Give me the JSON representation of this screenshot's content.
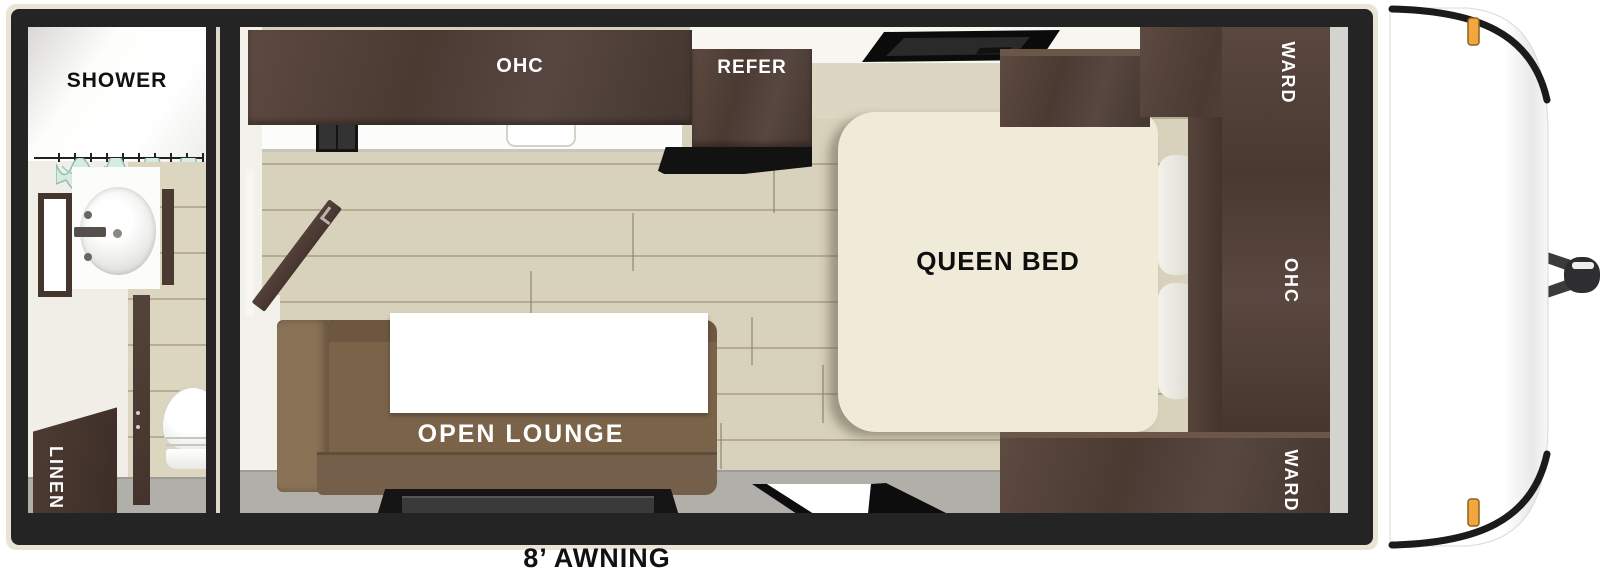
{
  "floorplan": {
    "awning_label": "8’ AWNING",
    "bathroom": {
      "shower_label": "SHOWER",
      "linen_label": "LINEN"
    },
    "kitchen": {
      "overhead_cabinet_label": "OHC",
      "refrigerator_label": "REFER"
    },
    "living": {
      "lounge_label": "OPEN LOUNGE"
    },
    "bedroom": {
      "bed_label": "QUEEN BED",
      "wardrobe_top_label": "WARD",
      "overhead_cabinet_label": "OHC",
      "wardrobe_bottom_label": "WARD"
    },
    "colors": {
      "wall": "#242424",
      "outline": "#e9e4d6",
      "cabinet": "#4e3d34",
      "floor": "#d8d1bb",
      "grey-floor": "#b1afa9",
      "sofa": "#7b634a",
      "mattress": "#f0ebd9",
      "marker": "#f1a63e",
      "curtain": "#d6ebe2"
    }
  }
}
